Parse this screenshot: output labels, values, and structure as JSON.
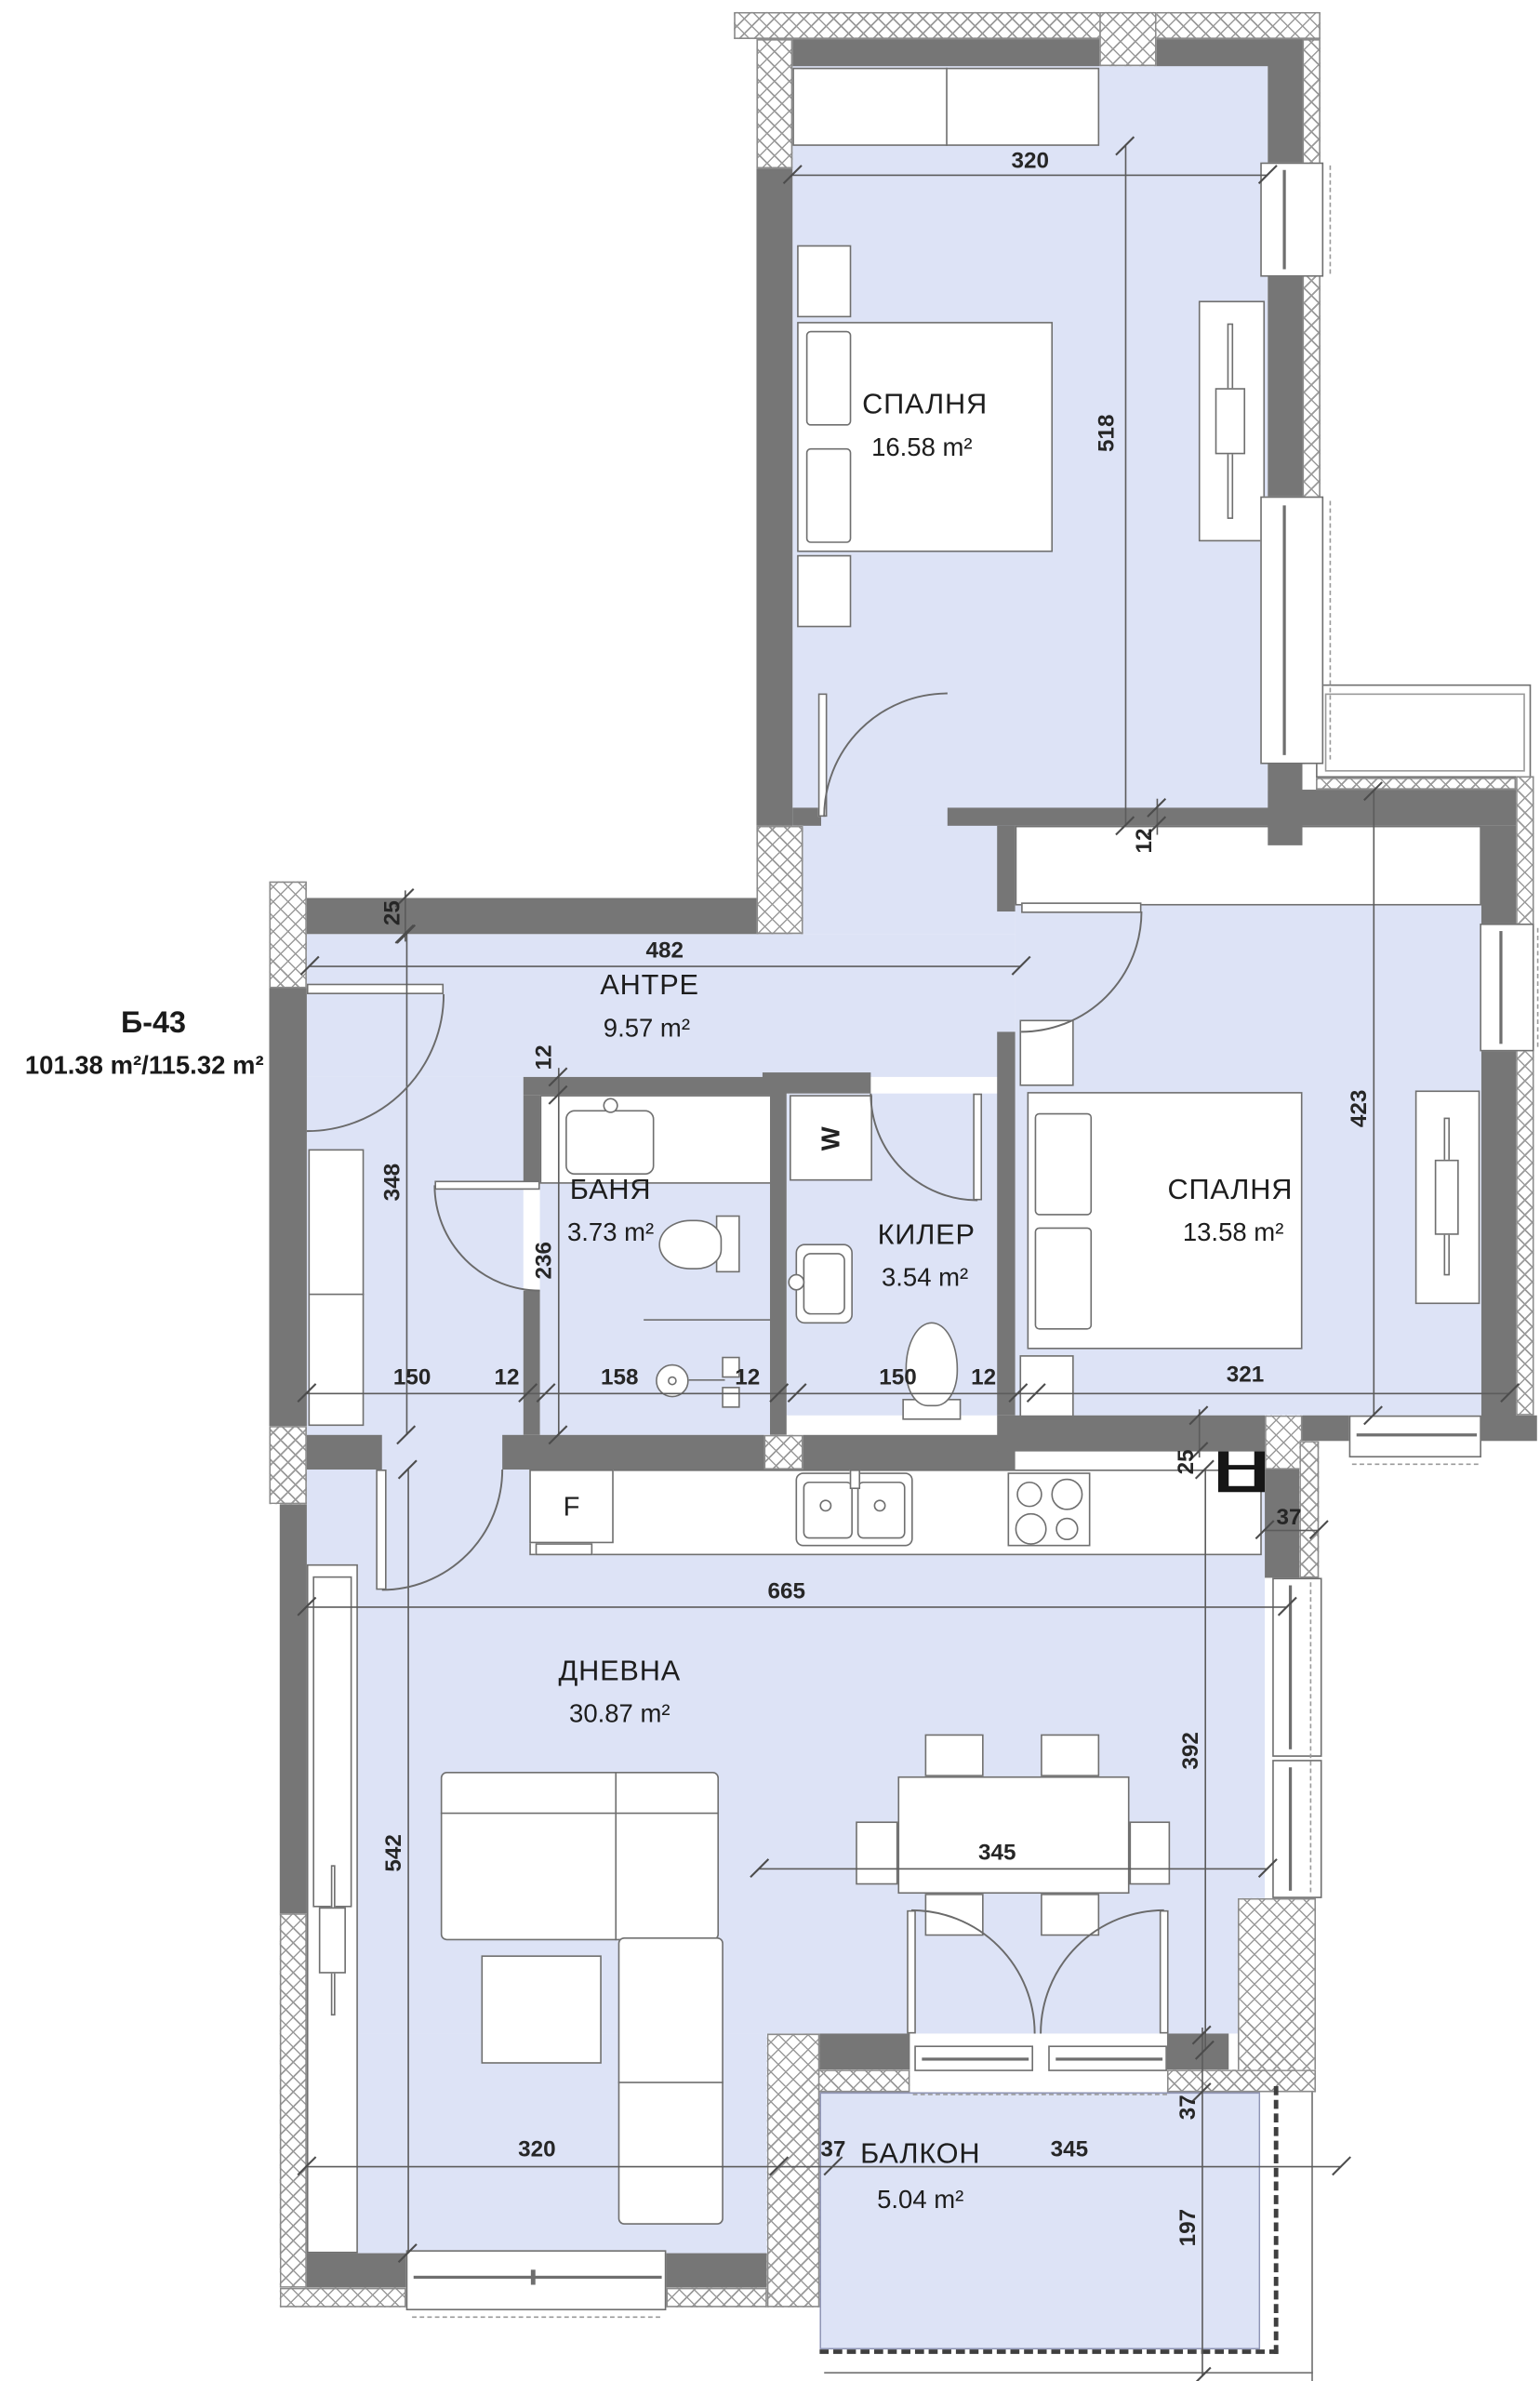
{
  "title": {
    "unit": "Б-43",
    "areas": "101.38 m²/115.32 m²"
  },
  "rooms": [
    {
      "name": "СПАЛНЯ",
      "area": "16.58 m²"
    },
    {
      "name": "АНТРЕ",
      "area": "9.57 m²"
    },
    {
      "name": "БАНЯ",
      "area": "3.73 m²"
    },
    {
      "name": "КИЛЕР",
      "area": "3.54 m²"
    },
    {
      "name": "СПАЛНЯ",
      "area": "13.58 m²"
    },
    {
      "name": "ДНЕВНА",
      "area": "30.87 m²"
    },
    {
      "name": "БАЛКОН",
      "area": "5.04 m²"
    }
  ],
  "dims": [
    "320",
    "518",
    "482",
    "25",
    "12",
    "12",
    "423",
    "348",
    "236",
    "150",
    "12",
    "158",
    "12",
    "150",
    "12",
    "321",
    "25",
    "665",
    "37",
    "542",
    "392",
    "345",
    "320",
    "37",
    "345",
    "37",
    "197"
  ],
  "fixtures": {
    "fridge": "F",
    "washer": "W"
  },
  "colors": {
    "room_fill": "#dde3f6",
    "wall": "#767676",
    "dimension_text": "#262626"
  }
}
